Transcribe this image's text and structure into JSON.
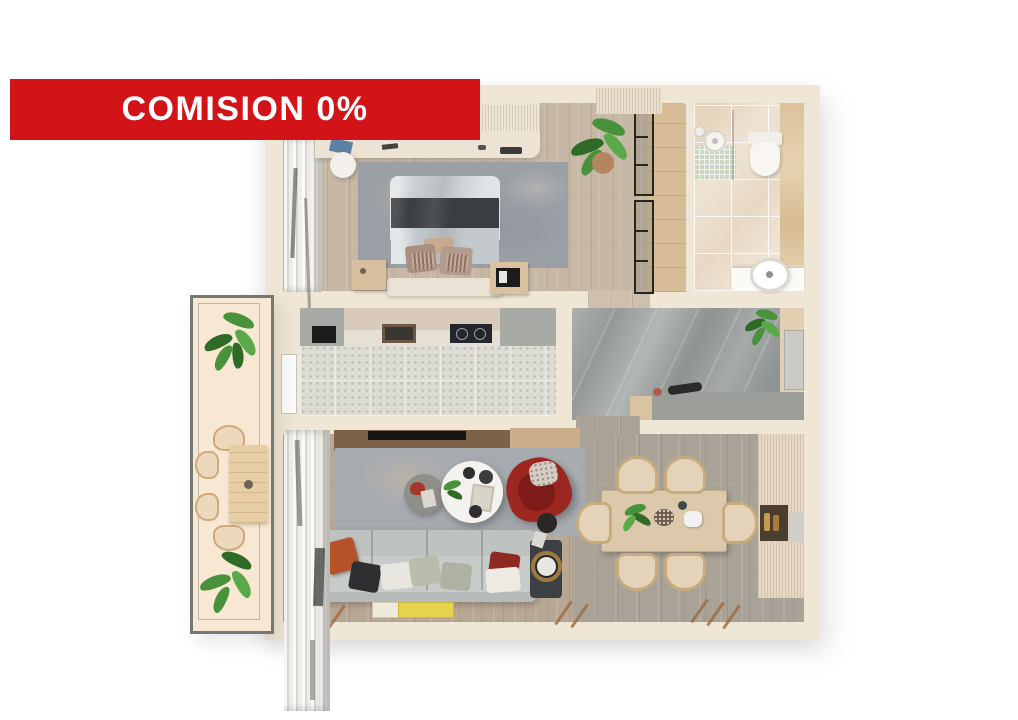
{
  "banner": {
    "label": "COMISION 0%"
  },
  "palette": {
    "banner_red": "#d21418",
    "banner_text": "#ffffff",
    "wall_cream": "#f0e6d5",
    "plant_green_dark": "#2f6b27",
    "plant_green_mid": "#47923a",
    "plant_green_light": "#5aa84a",
    "armchair_red": "#9c2721",
    "sofa_gray": "#c7cbc9",
    "balcony_floor": "#f8e8d3"
  }
}
